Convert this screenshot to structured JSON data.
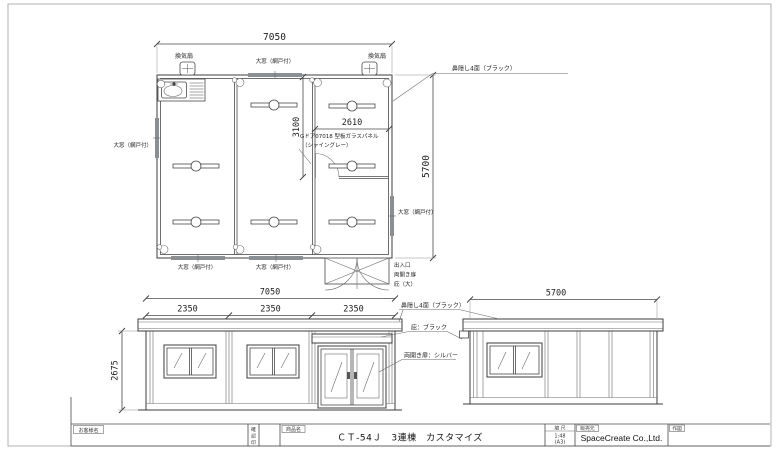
{
  "drawing": {
    "bg": "#ffffff",
    "line_color": "#4a4a4a"
  },
  "floor_plan": {
    "dims": {
      "width": "7050",
      "height": "5700",
      "room_width": "2610",
      "room_height": "3100"
    },
    "labels": {
      "fan_left": "換気扇",
      "fan_right": "換気扇",
      "window_top": "大窓（網戸付）",
      "window_left": "大窓（網戸付）",
      "window_right": "大窓（網戸付）",
      "window_bottom_1": "大窓（網戸付）",
      "window_bottom_2": "大窓（網戸付）",
      "fascia": "鼻隠し4面（ブラック）",
      "glass_door_1": "Gドア07018 型板ガラスパネル",
      "glass_door_2": "（シャイングレー）",
      "entrance_1": "出入口",
      "entrance_2": "両開き扉",
      "entrance_3": "庇（大）"
    }
  },
  "front_elevation": {
    "dims": {
      "total": "7050",
      "module_1": "2350",
      "module_2": "2350",
      "module_3": "2350",
      "height": "2675"
    },
    "labels": {
      "fascia": "鼻隠し4面（ブラック）",
      "canopy": "庇：ブラック",
      "door": "両開き扉：シルバー"
    }
  },
  "side_elevation": {
    "dims": {
      "total": "5700"
    }
  },
  "title_block": {
    "customer_label": "お客様名",
    "approval_chars": [
      "確",
      "認",
      "印"
    ],
    "product_label": "商品名",
    "product_name": "ＣＴ-54Ｊ　3連棟　カスタマイズ",
    "scale_label": "縮 尺",
    "scale_value": "1:48",
    "scale_paper": "(A3)",
    "vendor_label": "販売元",
    "vendor_name": "SpaceCreate Co.,Ltd.",
    "drafter_label": "作図"
  }
}
